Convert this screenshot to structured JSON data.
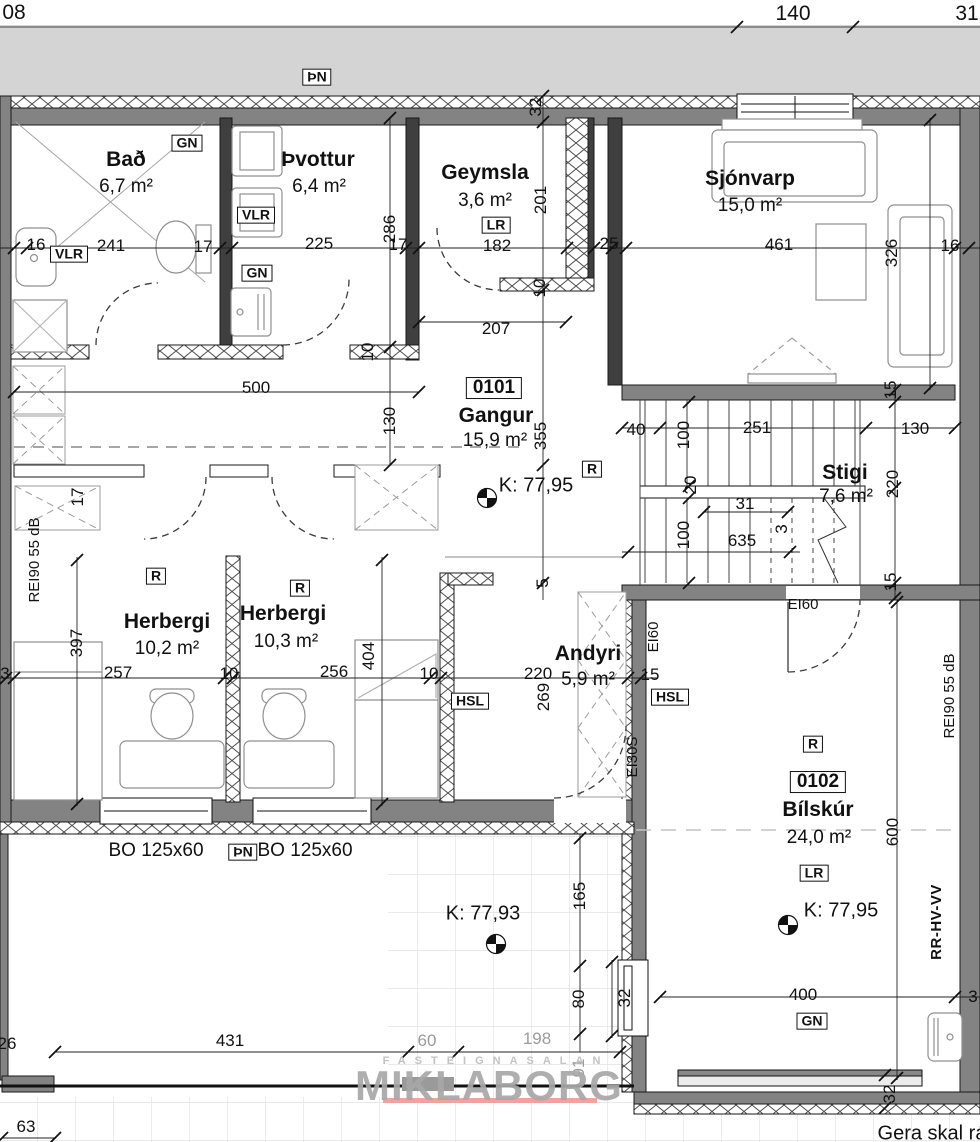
{
  "drawing": {
    "type": "architectural floor plan",
    "watermark": {
      "small": "FASTEIGNASALAN",
      "large": "MIKLABORG",
      "underline_color": "#f1a29d"
    },
    "note_bottom_right": "Gera skal rá",
    "colors": {
      "wall": "#838383",
      "dark_wall": "#3f3f3f",
      "outside_band": "#d4d4d4",
      "dim_text": "#111111",
      "gray_dim": "#9b9b9b"
    }
  },
  "rooms": [
    {
      "number": "0101",
      "name": "Gangur",
      "area": "15,9 m²"
    },
    {
      "number": "0102",
      "name": "Bílskúr",
      "area": "24,0 m²"
    },
    {
      "name": "Bað",
      "area": "6,7 m²"
    },
    {
      "name": "Þvottur",
      "area": "6,4 m²"
    },
    {
      "name": "Geymsla",
      "area": "3,6 m²"
    },
    {
      "name": "Sjónvarp",
      "area": "15,0 m²"
    },
    {
      "name": "Stigi",
      "area": "7,6 m²"
    },
    {
      "name": "Herbergi",
      "area": "10,2 m²"
    },
    {
      "name": "Herbergi",
      "area": "10,3 m²"
    },
    {
      "name": "Andyri",
      "area": "5,9 m²"
    }
  ],
  "levels": [
    {
      "label": "K: 77,95",
      "location": "Gangur"
    },
    {
      "label": "K: 77,93",
      "location": "terrace"
    },
    {
      "label": "K: 77,95",
      "location": "Bílskúr"
    }
  ],
  "tags": [
    "ÞN",
    "GN",
    "VLR",
    "LR",
    "R",
    "HSL",
    "EI60",
    "EI30S",
    "REI90 55 dB",
    "RR-HV-VV",
    "BO 125x60"
  ],
  "labels": [
    {
      "name": "dim-08",
      "text": "08",
      "x": 14,
      "y": 13,
      "cls": "d dx"
    },
    {
      "name": "dim-140",
      "text": "140",
      "x": 793,
      "y": 14,
      "cls": "d dx"
    },
    {
      "name": "dim-31-top",
      "text": "31",
      "x": 967,
      "y": 14,
      "cls": "d dx"
    },
    {
      "name": "tag-thn-top",
      "text": "ÞN",
      "x": 317,
      "y": 77,
      "cls": "b"
    },
    {
      "name": "dim-32-top",
      "text": "32",
      "x": 536,
      "y": 107,
      "rot": 1,
      "cls": "d"
    },
    {
      "name": "room-bad",
      "text": "Bað",
      "x": 126,
      "y": 160,
      "cls": "r"
    },
    {
      "name": "area-bad",
      "text": "6,7 m²",
      "x": 126,
      "y": 187,
      "cls": "a"
    },
    {
      "name": "tag-gn-bad",
      "text": "GN",
      "x": 187,
      "y": 143,
      "cls": "b"
    },
    {
      "name": "room-thvottur",
      "text": "Þvottur",
      "x": 318,
      "y": 160,
      "cls": "r"
    },
    {
      "name": "area-thvottur",
      "text": "6,4 m²",
      "x": 319,
      "y": 187,
      "cls": "a"
    },
    {
      "name": "tag-vlr-thvottur",
      "text": "VLR",
      "x": 256,
      "y": 215,
      "cls": "b"
    },
    {
      "name": "tag-gn-thvottur",
      "text": "GN",
      "x": 257,
      "y": 273,
      "cls": "b"
    },
    {
      "name": "room-geymsla",
      "text": "Geymsla",
      "x": 485,
      "y": 173,
      "cls": "r"
    },
    {
      "name": "area-geymsla",
      "text": "3,6 m²",
      "x": 485,
      "y": 201,
      "cls": "a"
    },
    {
      "name": "tag-lr-geymsla",
      "text": "LR",
      "x": 496,
      "y": 225,
      "cls": "b"
    },
    {
      "name": "dim-201",
      "text": "201",
      "x": 541,
      "y": 200,
      "rot": 1,
      "cls": "d"
    },
    {
      "name": "room-sjonvarp",
      "text": "Sjónvarp",
      "x": 750,
      "y": 179,
      "cls": "r"
    },
    {
      "name": "area-sjonvarp",
      "text": "15,0 m²",
      "x": 750,
      "y": 206,
      "cls": "a"
    },
    {
      "name": "dim-16-left",
      "text": "16",
      "x": 36,
      "y": 245,
      "cls": "d"
    },
    {
      "name": "tag-vlr-bad",
      "text": "VLR",
      "x": 69,
      "y": 254,
      "cls": "b"
    },
    {
      "name": "dim-241",
      "text": "241",
      "x": 111,
      "y": 246,
      "cls": "d"
    },
    {
      "name": "dim-17-a",
      "text": "17",
      "x": 203,
      "y": 247,
      "cls": "d"
    },
    {
      "name": "dim-225",
      "text": "225",
      "x": 319,
      "y": 244,
      "cls": "d"
    },
    {
      "name": "dim-286",
      "text": "286",
      "x": 390,
      "y": 229,
      "rot": 1,
      "cls": "d"
    },
    {
      "name": "dim-17-b",
      "text": "17",
      "x": 398,
      "y": 245,
      "cls": "d"
    },
    {
      "name": "dim-182",
      "text": "182",
      "x": 497,
      "y": 246,
      "cls": "d"
    },
    {
      "name": "dim-25",
      "text": "25",
      "x": 609,
      "y": 244,
      "cls": "d"
    },
    {
      "name": "dim-461",
      "text": "461",
      "x": 779,
      "y": 245,
      "cls": "d"
    },
    {
      "name": "dim-326",
      "text": "326",
      "x": 892,
      "y": 253,
      "rot": 1,
      "cls": "d"
    },
    {
      "name": "dim-16-right",
      "text": "16",
      "x": 950,
      "y": 246,
      "cls": "d"
    },
    {
      "name": "dim-10-geymsla",
      "text": "10",
      "x": 540,
      "y": 288,
      "rot": 1,
      "cls": "d"
    },
    {
      "name": "dim-207",
      "text": "207",
      "x": 496,
      "y": 329,
      "cls": "d"
    },
    {
      "name": "dim-10-wall",
      "text": "10",
      "x": 368,
      "y": 352,
      "rot": 1,
      "cls": "d"
    },
    {
      "name": "dim-500",
      "text": "500",
      "x": 256,
      "y": 388,
      "cls": "d"
    },
    {
      "name": "dim-130-left",
      "text": "130",
      "x": 390,
      "y": 421,
      "rot": 1,
      "cls": "d"
    },
    {
      "name": "roomnum-0101",
      "text": "0101",
      "x": 494,
      "y": 388,
      "cls": "bn"
    },
    {
      "name": "room-gangur",
      "text": "Gangur",
      "x": 496,
      "y": 416,
      "cls": "r"
    },
    {
      "name": "area-gangur",
      "text": "15,9 m²",
      "x": 495,
      "y": 441,
      "cls": "a"
    },
    {
      "name": "dim-355",
      "text": "355",
      "x": 541,
      "y": 436,
      "rot": 1,
      "cls": "d"
    },
    {
      "name": "level-gangur",
      "text": "K: 77,95",
      "x": 536,
      "y": 486,
      "cls": "lv"
    },
    {
      "name": "tag-r-gangur",
      "text": "R",
      "x": 592,
      "y": 469,
      "cls": "b"
    },
    {
      "name": "dim-40",
      "text": "40",
      "x": 636,
      "y": 430,
      "cls": "d"
    },
    {
      "name": "dim-100-a",
      "text": "100",
      "x": 684,
      "y": 435,
      "rot": 1,
      "cls": "d"
    },
    {
      "name": "dim-251",
      "text": "251",
      "x": 757,
      "y": 428,
      "cls": "d"
    },
    {
      "name": "dim-130-right",
      "text": "130",
      "x": 915,
      "y": 429,
      "cls": "d"
    },
    {
      "name": "room-stigi",
      "text": "Stigi",
      "x": 845,
      "y": 473,
      "cls": "r"
    },
    {
      "name": "area-stigi",
      "text": "7,6 m²",
      "x": 846,
      "y": 497,
      "cls": "a"
    },
    {
      "name": "dim-220-stigi",
      "text": "220",
      "x": 893,
      "y": 484,
      "rot": 1,
      "cls": "d"
    },
    {
      "name": "dim-20",
      "text": "20",
      "x": 691,
      "y": 485,
      "rot": 1,
      "cls": "d"
    },
    {
      "name": "dim-31-stigi",
      "text": "31",
      "x": 745,
      "y": 504,
      "cls": "d"
    },
    {
      "name": "dim-100-b",
      "text": "100",
      "x": 684,
      "y": 535,
      "rot": 1,
      "cls": "d"
    },
    {
      "name": "dim-635",
      "text": "635",
      "x": 742,
      "y": 541,
      "cls": "d"
    },
    {
      "name": "dim-3-stigi",
      "text": "3",
      "x": 782,
      "y": 529,
      "rot": 1,
      "cls": "d"
    },
    {
      "name": "dim-15-stigi-top",
      "text": "15",
      "x": 891,
      "y": 390,
      "rot": 1,
      "cls": "d"
    },
    {
      "name": "dim-15-stigi-bot",
      "text": "15",
      "x": 891,
      "y": 582,
      "rot": 1,
      "cls": "d"
    },
    {
      "name": "note-rei90-left",
      "text": "REI90  55 dB",
      "x": 35,
      "y": 560,
      "rot": 1,
      "cls": "n"
    },
    {
      "name": "dim-17-c",
      "text": "17",
      "x": 78,
      "y": 497,
      "rot": 1,
      "cls": "d"
    },
    {
      "name": "tag-r-herbergi1",
      "text": "R",
      "x": 156,
      "y": 576,
      "cls": "b"
    },
    {
      "name": "room-herbergi1",
      "text": "Herbergi",
      "x": 167,
      "y": 622,
      "cls": "r"
    },
    {
      "name": "area-herbergi1",
      "text": "10,2 m²",
      "x": 167,
      "y": 649,
      "cls": "a"
    },
    {
      "name": "tag-r-herbergi2",
      "text": "R",
      "x": 300,
      "y": 588,
      "cls": "b"
    },
    {
      "name": "room-herbergi2",
      "text": "Herbergi",
      "x": 283,
      "y": 614,
      "cls": "r"
    },
    {
      "name": "area-herbergi2",
      "text": "10,3 m²",
      "x": 286,
      "y": 642,
      "cls": "a"
    },
    {
      "name": "dim-397",
      "text": "397",
      "x": 77,
      "y": 643,
      "rot": 1,
      "cls": "d"
    },
    {
      "name": "dim-3-left",
      "text": "3",
      "x": 5,
      "y": 674,
      "cls": "d"
    },
    {
      "name": "dim-257",
      "text": "257",
      "x": 118,
      "y": 673,
      "cls": "d"
    },
    {
      "name": "dim-10-b",
      "text": "10",
      "x": 229,
      "y": 674,
      "cls": "d"
    },
    {
      "name": "dim-256",
      "text": "256",
      "x": 334,
      "y": 672,
      "cls": "d"
    },
    {
      "name": "dim-404",
      "text": "404",
      "x": 369,
      "y": 656,
      "rot": 1,
      "cls": "d"
    },
    {
      "name": "dim-10-c",
      "text": "10",
      "x": 429,
      "y": 674,
      "cls": "d"
    },
    {
      "name": "dim-220-andyri",
      "text": "220",
      "x": 538,
      "y": 674,
      "cls": "d"
    },
    {
      "name": "dim-269",
      "text": "269",
      "x": 544,
      "y": 697,
      "rot": 1,
      "cls": "d"
    },
    {
      "name": "dim-5",
      "text": "5",
      "x": 543,
      "y": 583,
      "rot": 1,
      "cls": "d"
    },
    {
      "name": "tag-hsl-left",
      "text": "HSL",
      "x": 470,
      "y": 701,
      "cls": "b"
    },
    {
      "name": "room-andyri",
      "text": "Andyri",
      "x": 588,
      "y": 654,
      "cls": "r"
    },
    {
      "name": "area-andyri",
      "text": "5,9 m²",
      "x": 588,
      "y": 680,
      "cls": "a"
    },
    {
      "name": "dim-15-andyri",
      "text": "15",
      "x": 650,
      "y": 675,
      "cls": "d"
    },
    {
      "name": "tag-hsl-right",
      "text": "HSL",
      "x": 670,
      "y": 697,
      "cls": "b"
    },
    {
      "name": "note-ei60-vert",
      "text": "EI60",
      "x": 654,
      "y": 637,
      "rot": 1,
      "cls": "n"
    },
    {
      "name": "note-ei30s",
      "text": "EI30S",
      "x": 633,
      "y": 757,
      "rot": 1,
      "cls": "n"
    },
    {
      "name": "note-ei60-top",
      "text": "EI60",
      "x": 803,
      "y": 605,
      "cls": "n"
    },
    {
      "name": "tag-r-bilskur",
      "text": "R",
      "x": 813,
      "y": 744,
      "cls": "b"
    },
    {
      "name": "roomnum-0102",
      "text": "0102",
      "x": 818,
      "y": 782,
      "cls": "bn"
    },
    {
      "name": "room-bilskur",
      "text": "Bílskúr",
      "x": 818,
      "y": 810,
      "cls": "r"
    },
    {
      "name": "area-bilskur",
      "text": "24,0 m²",
      "x": 819,
      "y": 838,
      "cls": "a"
    },
    {
      "name": "tag-lr-bilskur",
      "text": "LR",
      "x": 814,
      "y": 873,
      "cls": "b"
    },
    {
      "name": "level-bilskur",
      "text": "K: 77,95",
      "x": 841,
      "y": 911,
      "cls": "lv"
    },
    {
      "name": "dim-600",
      "text": "600",
      "x": 893,
      "y": 832,
      "rot": 1,
      "cls": "d"
    },
    {
      "name": "note-rei90-right",
      "text": "REI90  55 dB",
      "x": 950,
      "y": 696,
      "rot": 1,
      "cls": "n"
    },
    {
      "name": "note-rr-hv-vv",
      "text": "RR-HV-VV",
      "x": 937,
      "y": 922,
      "rot": 1,
      "cls": "nb"
    },
    {
      "name": "dim-400",
      "text": "400",
      "x": 803,
      "y": 995,
      "cls": "d"
    },
    {
      "name": "tag-gn-bilskur",
      "text": "GN",
      "x": 812,
      "y": 1021,
      "cls": "b"
    },
    {
      "name": "dim-32-garwin",
      "text": "32",
      "x": 625,
      "y": 998,
      "rot": 1,
      "cls": "d"
    },
    {
      "name": "dim-32-gardoor",
      "text": "32",
      "x": 890,
      "y": 1094,
      "rot": 1,
      "cls": "d"
    },
    {
      "name": "dim-3-right",
      "text": "3",
      "x": 973,
      "y": 997,
      "cls": "d"
    },
    {
      "name": "window-bo-1",
      "text": "BO 125x60",
      "x": 156,
      "y": 851,
      "cls": "a"
    },
    {
      "name": "tag-thn-bottom",
      "text": "ÞN",
      "x": 243,
      "y": 852,
      "cls": "b"
    },
    {
      "name": "window-bo-2",
      "text": "BO 125x60",
      "x": 305,
      "y": 851,
      "cls": "a"
    },
    {
      "name": "level-terrace",
      "text": "K: 77,93",
      "x": 483,
      "y": 914,
      "cls": "lv"
    },
    {
      "name": "dim-165",
      "text": "165",
      "x": 580,
      "y": 896,
      "rot": 1,
      "cls": "d"
    },
    {
      "name": "dim-80",
      "text": "80",
      "x": 579,
      "y": 999,
      "rot": 1,
      "cls": "d"
    },
    {
      "name": "dim-60",
      "text": "60",
      "x": 427,
      "y": 1041,
      "cls": "d dg"
    },
    {
      "name": "dim-198",
      "text": "198",
      "x": 537,
      "y": 1039,
      "cls": "d dg"
    },
    {
      "name": "dim-91",
      "text": "91",
      "x": 579,
      "y": 1068,
      "rot": 1,
      "cls": "d dg"
    },
    {
      "name": "watermark-small",
      "text": "FASTEIGNASALAN",
      "x": 496,
      "y": 1062,
      "cls": "ws"
    },
    {
      "name": "watermark-large",
      "text": "MIKLABORG",
      "x": 489,
      "y": 1086,
      "cls": "wl"
    },
    {
      "name": "dim-431",
      "text": "431",
      "x": 230,
      "y": 1041,
      "cls": "d"
    },
    {
      "name": "dim-26",
      "text": "26",
      "x": 7,
      "y": 1044,
      "cls": "d"
    },
    {
      "name": "dim-63",
      "text": "63",
      "x": 26,
      "y": 1127,
      "cls": "d"
    },
    {
      "name": "note-gera",
      "text": "Gera skal rá",
      "x": 932,
      "y": 1134,
      "cls": "ng"
    }
  ]
}
